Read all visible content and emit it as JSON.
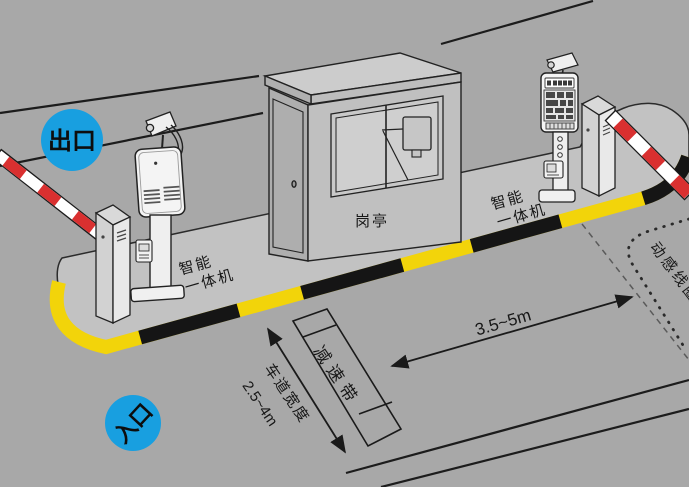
{
  "diagram": {
    "exit": {
      "badge": "出口"
    },
    "entrance": {
      "badge": "入口"
    },
    "booth_label": "岗亭",
    "smart_machine_label": {
      "line1": "智能",
      "line2": "一体机"
    },
    "annotations": {
      "speed_bump": "减速带",
      "lane_width": "车道宽度",
      "lane_width_range": "2.5~4m",
      "approach_distance": "3.5~5m",
      "sensor_coil": "动感线圈"
    },
    "colors": {
      "background": "#a8a8a8",
      "island": "#c2c2c2",
      "badge_blue": "#189fe0",
      "stripe_yellow": "#f2d40a",
      "stripe_black": "#151515",
      "barrier_red": "#d93030",
      "line_black": "#1c1c1c"
    }
  }
}
